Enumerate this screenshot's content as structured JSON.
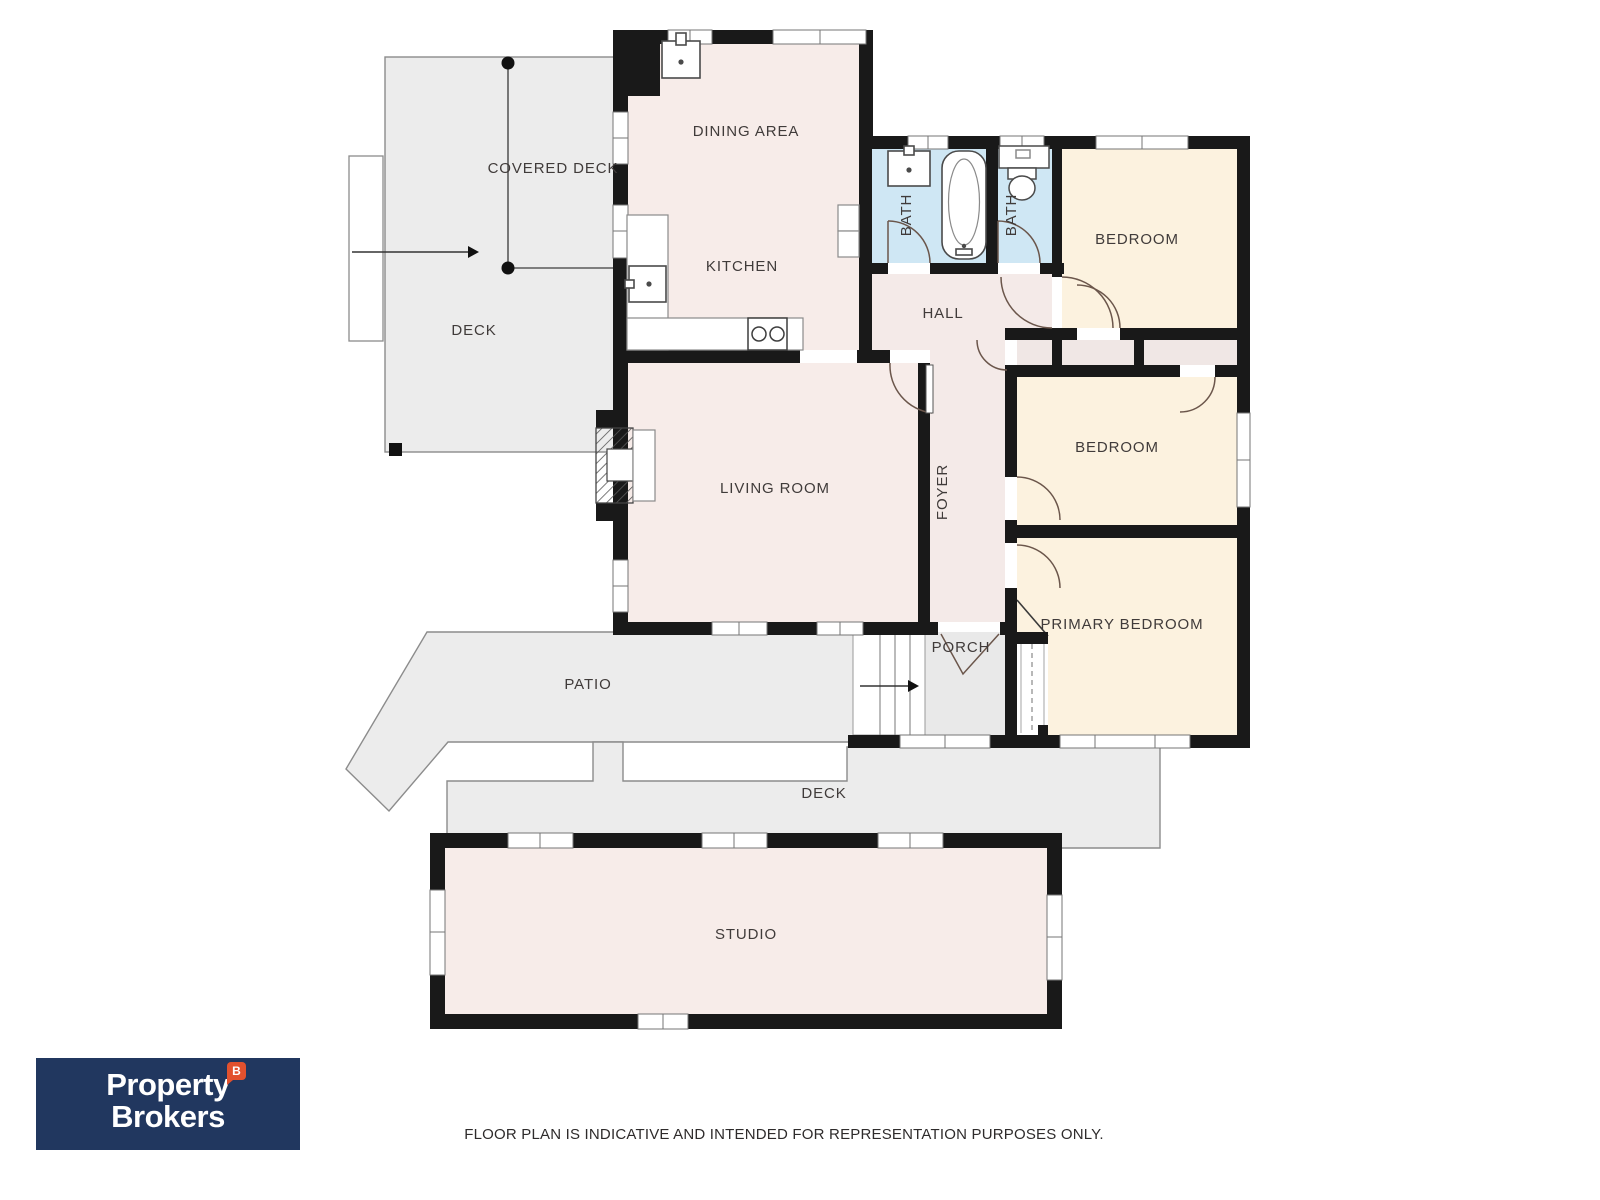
{
  "plan": {
    "labels": {
      "covered_deck": "COVERED DECK",
      "deck_upper": "DECK",
      "dining": "DINING AREA",
      "kitchen": "KITCHEN",
      "bath_1": "BATH",
      "bath_2": "BATH",
      "bedroom_top": "BEDROOM",
      "hall": "HALL",
      "living": "LIVING ROOM",
      "foyer": "FOYER",
      "bedroom_mid": "BEDROOM",
      "primary": "PRIMARY BEDROOM",
      "porch": "PORCH",
      "patio": "PATIO",
      "deck_lower": "DECK",
      "studio": "STUDIO"
    },
    "colors": {
      "wall": "#191919",
      "room_pink": "#f7ece9",
      "closet_pink": "#f0e7e5",
      "bedroom_cream": "#fcf2df",
      "bath_blue": "#cfe7f4",
      "outdoor_gray": "#ececec",
      "porch_gray": "#e9e9e9",
      "label_text": "#403b3a"
    }
  },
  "branding": {
    "logo_line1": "Property",
    "logo_line2": "Brokers",
    "logo_badge": "B",
    "navy": "#21375f",
    "red": "#e2512e"
  },
  "footer": {
    "disclaimer": "FLOOR PLAN IS INDICATIVE AND INTENDED FOR REPRESENTATION PURPOSES ONLY."
  }
}
